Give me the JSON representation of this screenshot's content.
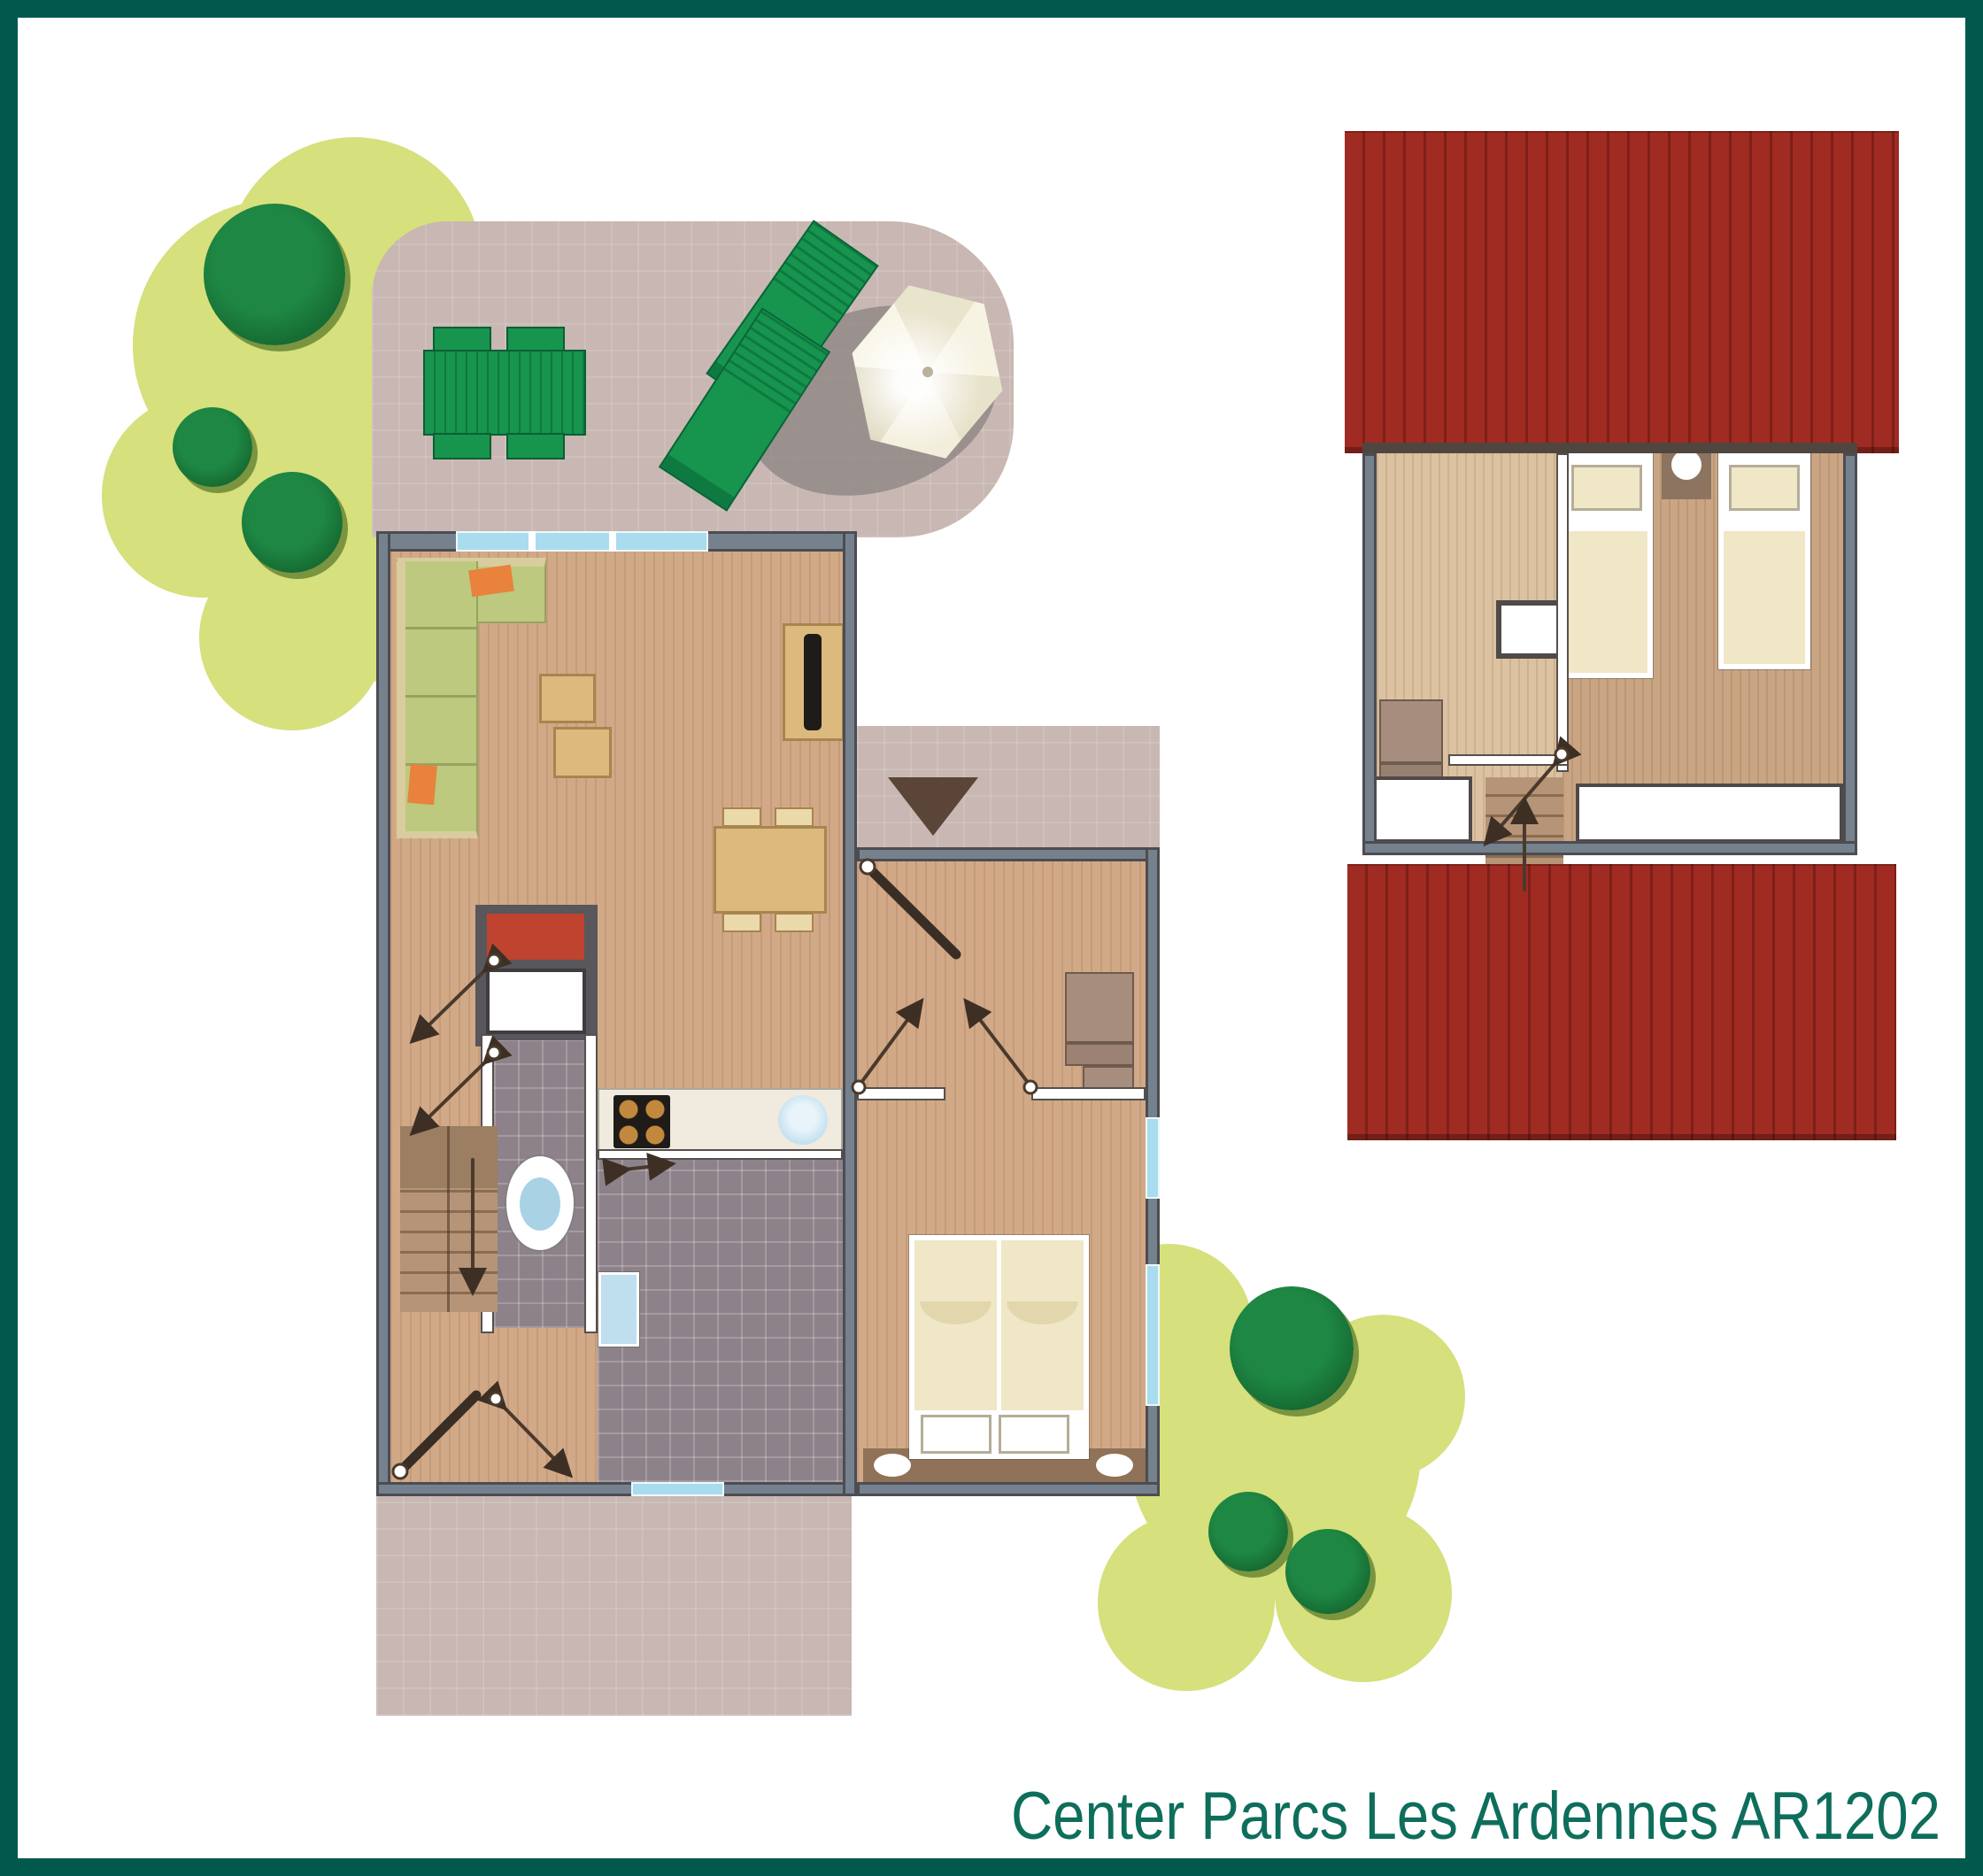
{
  "caption": {
    "text": "Center Parcs Les Ardennes AR1202"
  },
  "plan": {
    "name": "holiday cottage floor plan",
    "floors": [
      "ground-floor",
      "upper-floor"
    ],
    "ground_floor_items": [
      "corner-sofa",
      "coffee-tables",
      "tv-sideboard",
      "dining-table",
      "kitchen-counter",
      "hob",
      "sink",
      "heater-unit",
      "toilet",
      "shower-room",
      "washbasin",
      "stairs",
      "double-bed",
      "wardrobe",
      "entrance-porch",
      "terrace",
      "garden-table",
      "sun-loungers",
      "parasol"
    ],
    "upper_floor_items": [
      "roof",
      "twin-beds",
      "nightstand",
      "void",
      "wardrobe",
      "stairs"
    ]
  },
  "palette": {
    "frame": "#01594E",
    "caption": "#0E6E5C",
    "lawn": "#D6E07C",
    "treeMain": "#1E8744",
    "treeDark": "#15672F",
    "treeShadow": "#7A9440",
    "terrace": "#C8B7B2",
    "porchMat": "#B7A69F",
    "wallSlate": "#75828E",
    "wallDark": "#4C4C52",
    "wallWhiteEdge": "#55504C",
    "woodBase": "#D2A987",
    "woodUp": "#DCC2A1",
    "woodMid": "#C9A583",
    "tile": "#8D8289",
    "counter": "#F0EBDE",
    "roof": "#A02B22",
    "roofStripe": "#7D2019",
    "gardenGreen": "#17944E",
    "gardenGreenDark": "#0E7940",
    "sofaCushion": "#BDC97F",
    "sofaEdge": "#D9CC9F",
    "sofaLine": "#98A35F",
    "orange": "#E8823C",
    "tan": "#DCBA7E",
    "tanEdge": "#A8854E",
    "chairTan": "#EAD9AB",
    "tvBlack": "#1F1B18",
    "cream": "#F0E7C7",
    "pillowEdge": "#B5AD98",
    "nightstand": "#8D7460",
    "headboard": "#8F7257",
    "red": "#C0432F",
    "redFrame": "#59565C",
    "blueWin": "#A9DCEE",
    "blueFix": "#BFDFEF",
    "stepLight": "#B59478",
    "stepLine": "#8A6C50",
    "landing": "#9C7E62",
    "triangle": "#5B4438",
    "shadowGray": "#8B8381"
  }
}
